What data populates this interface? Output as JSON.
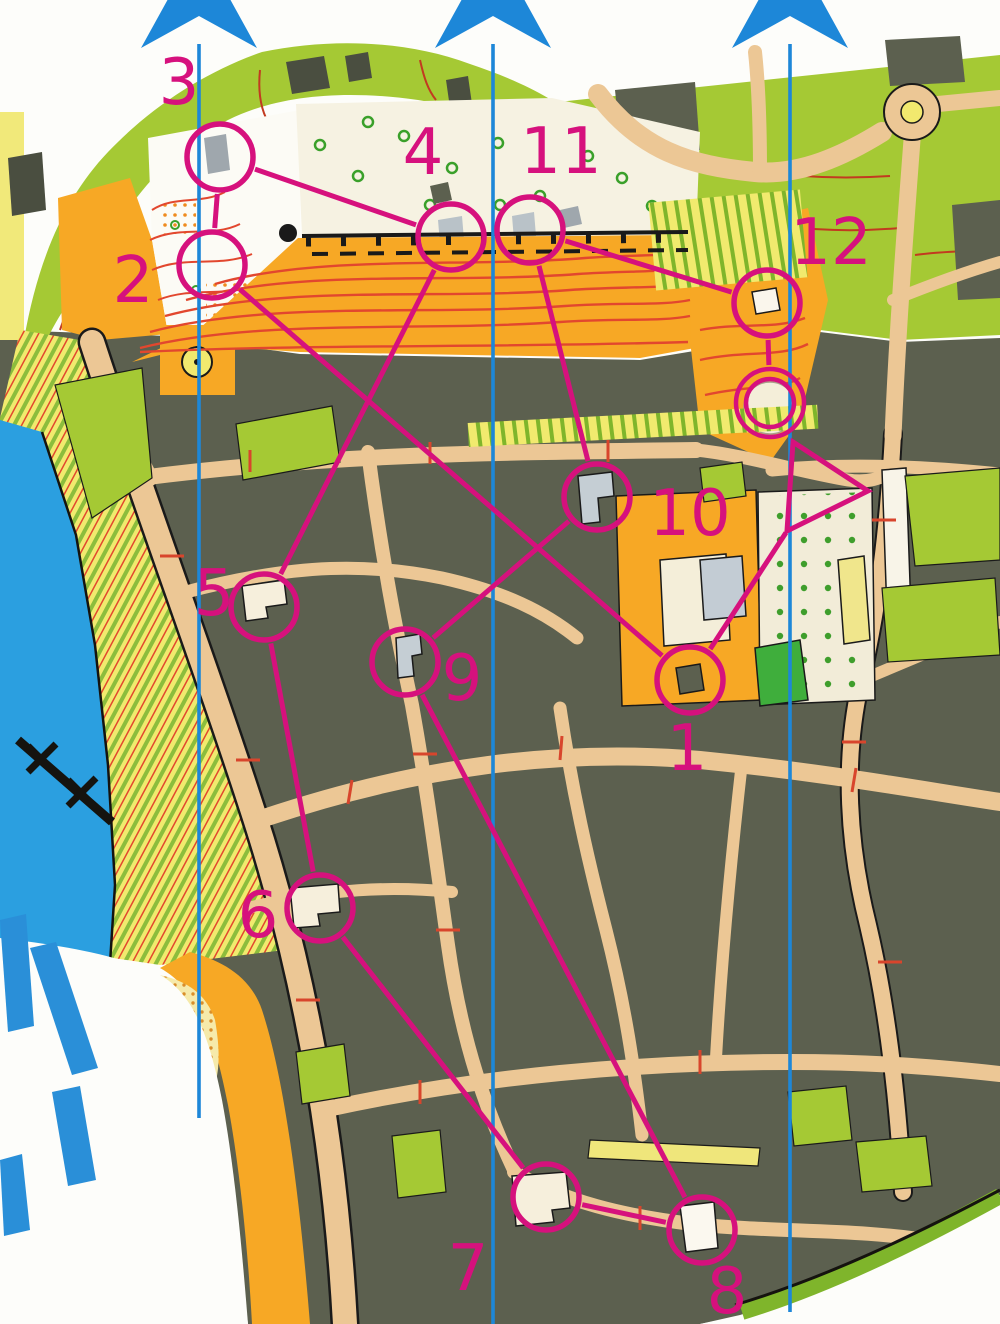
{
  "map": {
    "description": "Orienteering sprint map with 12-control course overprint",
    "course": {
      "color": "#d6117d",
      "control_radius": 33,
      "start": {
        "vertices": [
          [
            793,
            442
          ],
          [
            868,
            491
          ],
          [
            787,
            531
          ]
        ],
        "apex": [
          787,
          531
        ]
      },
      "finish": {
        "cx": 770,
        "cy": 403,
        "r_outer": 34,
        "r_inner": 24
      },
      "controls": [
        {
          "number": "1",
          "cx": 690,
          "cy": 680,
          "lx": 687,
          "ly": 770
        },
        {
          "number": "2",
          "cx": 212,
          "cy": 265,
          "lx": 133,
          "ly": 302
        },
        {
          "number": "3",
          "cx": 220,
          "cy": 157,
          "lx": 179,
          "ly": 104
        },
        {
          "number": "4",
          "cx": 451,
          "cy": 237,
          "lx": 423,
          "ly": 174
        },
        {
          "number": "5",
          "cx": 264,
          "cy": 607,
          "lx": 214,
          "ly": 615
        },
        {
          "number": "6",
          "cx": 320,
          "cy": 908,
          "lx": 258,
          "ly": 937
        },
        {
          "number": "7",
          "cx": 546,
          "cy": 1197,
          "lx": 468,
          "ly": 1290
        },
        {
          "number": "8",
          "cx": 702,
          "cy": 1230,
          "lx": 727,
          "ly": 1313
        },
        {
          "number": "9",
          "cx": 405,
          "cy": 662,
          "lx": 462,
          "ly": 700
        },
        {
          "number": "10",
          "cx": 597,
          "cy": 497,
          "lx": 690,
          "ly": 535
        },
        {
          "number": "11",
          "cx": 530,
          "cy": 230,
          "lx": 561,
          "ly": 173
        },
        {
          "number": "12",
          "cx": 767,
          "cy": 303,
          "lx": 831,
          "ly": 264
        }
      ],
      "legs": [
        [
          "start",
          "1"
        ],
        [
          "1",
          "2"
        ],
        [
          "2",
          "3"
        ],
        [
          "3",
          "4"
        ],
        [
          "4",
          "5"
        ],
        [
          "5",
          "6"
        ],
        [
          "6",
          "7"
        ],
        [
          "7",
          "8"
        ],
        [
          "8",
          "9"
        ],
        [
          "9",
          "10"
        ],
        [
          "10",
          "11"
        ],
        [
          "11",
          "12"
        ],
        [
          "12",
          "finish"
        ]
      ]
    },
    "north_lines": {
      "color": "#1d87d8",
      "symbol": "north-arrow-star",
      "star": {
        "outer_radius": 82,
        "inner_radius": 26,
        "center_y": -10
      },
      "lines": [
        {
          "x": 199,
          "y_top": 44,
          "y_bottom": 1118
        },
        {
          "x": 493,
          "y_top": 44,
          "y_bottom": 1324
        },
        {
          "x": 790,
          "y_top": 44,
          "y_bottom": 1312
        }
      ]
    },
    "terrain_colors": {
      "paper": "#fdfdfa",
      "building_olive": "#5c604f",
      "road_tan": "#ecc795",
      "open_orange": "#f7a825",
      "vegetation_green": "#a5c934",
      "bright_green": "#3fae3c",
      "water_blue": "#2b9fe0",
      "beach_yellow": "#f1ea6e",
      "paved_cream": "#f6f2e2",
      "contour_red": "#e2472e",
      "gray_building": "#c5ced4",
      "watermark_letter_blue": "#2a8fd8"
    }
  }
}
